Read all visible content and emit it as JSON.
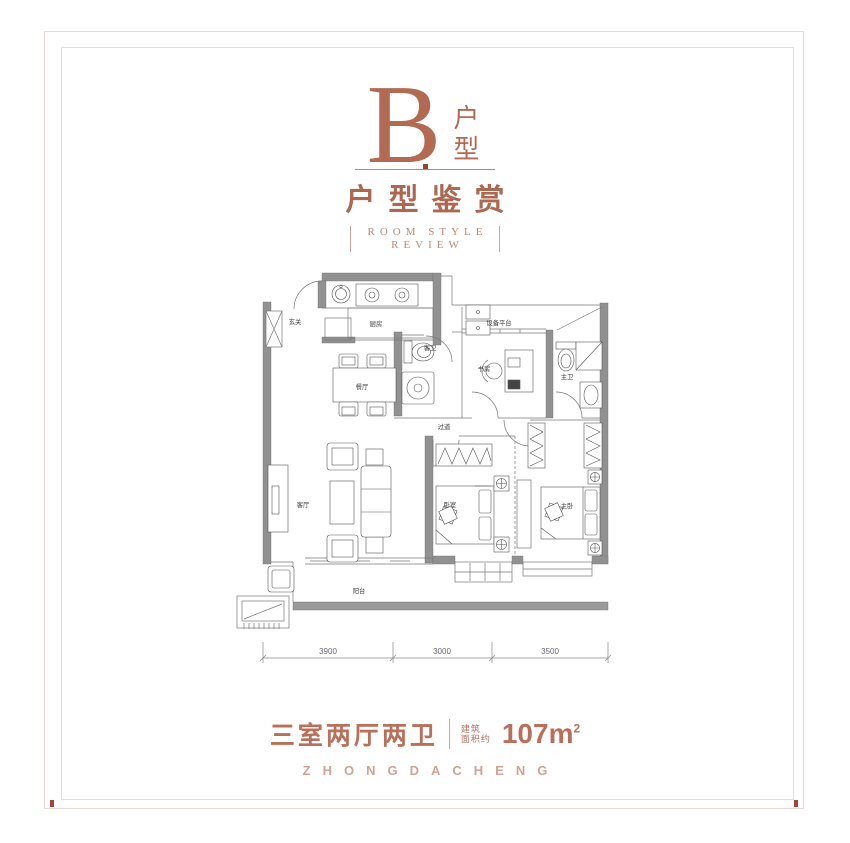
{
  "colors": {
    "accent": "#b26b52",
    "accent_light": "#cfa493",
    "frame": "#e8d9d6",
    "corner_mark": "#a84040",
    "wall": "#919191"
  },
  "header": {
    "letter": "B",
    "letter_label": "户型",
    "title": "户型鉴赏",
    "subtitle_line1": "ROOM STYLE",
    "subtitle_line2": "REVIEW"
  },
  "floor_plan": {
    "rooms": {
      "entry": "玄关",
      "kitchen": "厨房",
      "dining": "餐厅",
      "living": "客厅",
      "guest_bath": "客卫",
      "corridor": "过道",
      "study": "书房",
      "equipment_platform": "设备平台",
      "master_bath": "主卫",
      "bedroom": "卧室",
      "master_bedroom": "主卧",
      "balcony": "阳台"
    },
    "dimensions": [
      "3900",
      "3000",
      "3500"
    ]
  },
  "footer": {
    "layout": "三室两厅两卫",
    "area_label_top": "建筑",
    "area_label_bottom": "面积约",
    "area_value": "107m",
    "area_exponent": "2",
    "brand": "ZHONGDACHENG"
  }
}
